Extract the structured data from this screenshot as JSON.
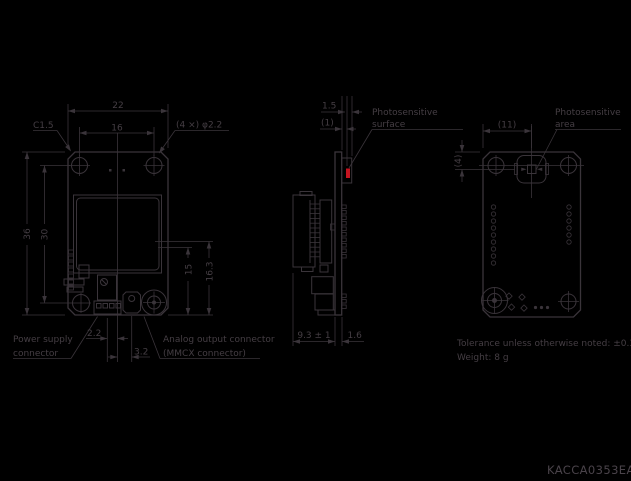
{
  "colors": {
    "background": "#000000",
    "line": "#3a343a",
    "text": "#453e44",
    "accent_red": "#c41420"
  },
  "front_view": {
    "dims": {
      "width": "22",
      "hole_spacing": "16",
      "chamfer": "C1.5",
      "holes": "(4 ×) φ2.2",
      "height": "36",
      "hole_v_spacing": "30",
      "mmcx_height": "15",
      "mmcx_height2": "16.3",
      "pin_offset": "2.2",
      "mmcx_offset": "3.2"
    },
    "labels": {
      "power_line1": "Power supply",
      "power_line2": "connector",
      "analog_line1": "Analog output connector",
      "analog_line2": "(MMCX connector)"
    }
  },
  "side_view": {
    "dims": {
      "surface_height": "1.5",
      "surface_depth": "(1)",
      "component_depth": "9.3 ± 1",
      "pcb_thickness": "1.6"
    },
    "labels": {
      "photo_line1": "Photosensitive",
      "photo_line2": "surface"
    }
  },
  "back_view": {
    "dims": {
      "sensor_offset_x": "(11)",
      "sensor_offset_y": "(4)"
    },
    "labels": {
      "photo_line1": "Photosensitive",
      "photo_line2": "area"
    }
  },
  "notes": {
    "tolerance": "Tolerance unless otherwise noted: ±0.3",
    "weight": "Weight: 8 g"
  },
  "drawing_code": "KACCA0353EA"
}
